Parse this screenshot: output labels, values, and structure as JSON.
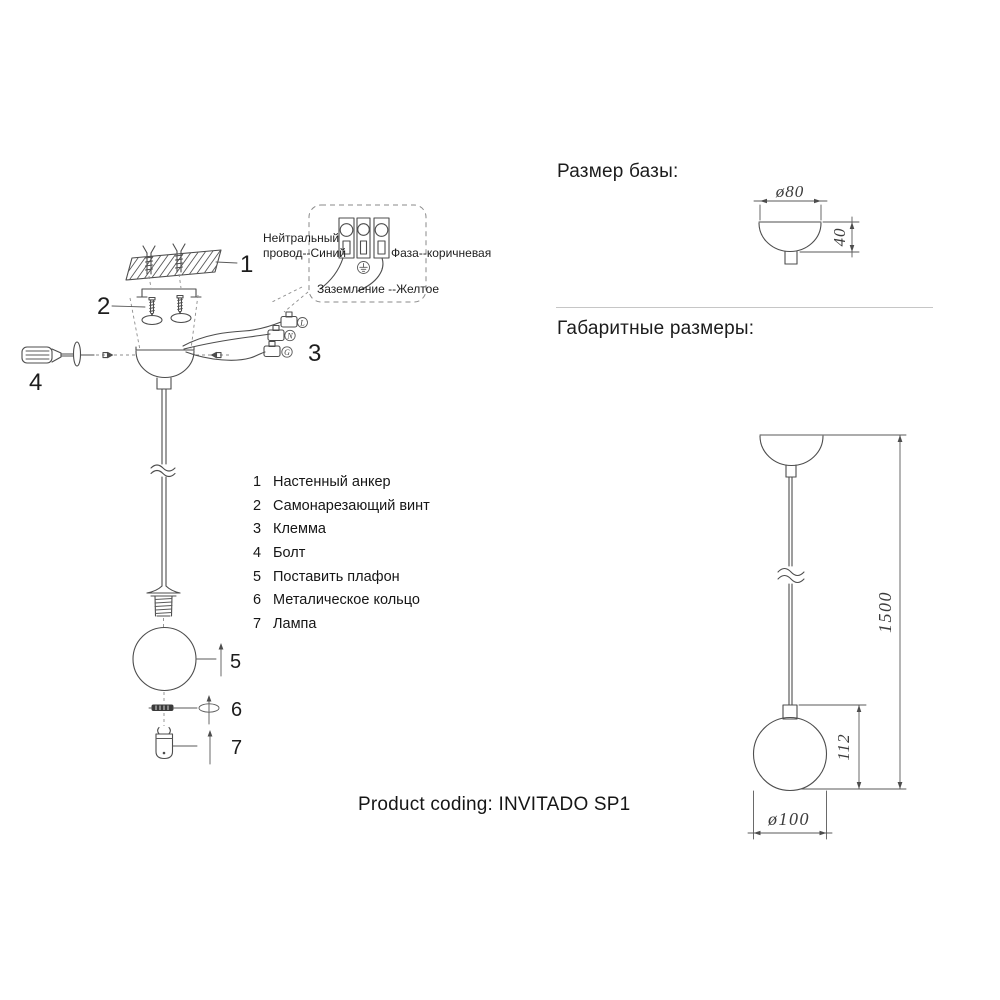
{
  "sheet": {
    "section_base_title": "Размер базы:",
    "section_overall_title": "Габаритные размеры:",
    "product_coding": "Product coding: INVITADO SP1"
  },
  "wiring": {
    "neutral_line1": "Нейтральный",
    "neutral_line2": "провод--Синий",
    "phase_label": "Фаза--коричневая",
    "ground_label": "Заземление --Желтое",
    "terminal_live": "L",
    "terminal_neutral": "N",
    "terminal_ground": "G"
  },
  "callouts": {
    "n1": "1",
    "n2": "2",
    "n3": "3",
    "n4": "4",
    "n5": "5",
    "n6": "6",
    "n7": "7"
  },
  "parts": [
    {
      "num": "1",
      "name": "Настенный анкер"
    },
    {
      "num": "2",
      "name": "Самонарезающий винт"
    },
    {
      "num": "3",
      "name": "Клемма"
    },
    {
      "num": "4",
      "name": "Болт"
    },
    {
      "num": "5",
      "name": "Поставить плафон"
    },
    {
      "num": "6",
      "name": "Металическое кольцо"
    },
    {
      "num": "7",
      "name": "Лампа"
    }
  ],
  "dims": {
    "base_diameter": "ø80",
    "base_height": "40",
    "total_height": "1500",
    "shade_height": "112",
    "shade_diameter": "ø100"
  },
  "colors": {
    "line": "#4d4d4d",
    "text": "#1a1a1a",
    "divider": "#c6c6c6",
    "background": "#ffffff"
  }
}
